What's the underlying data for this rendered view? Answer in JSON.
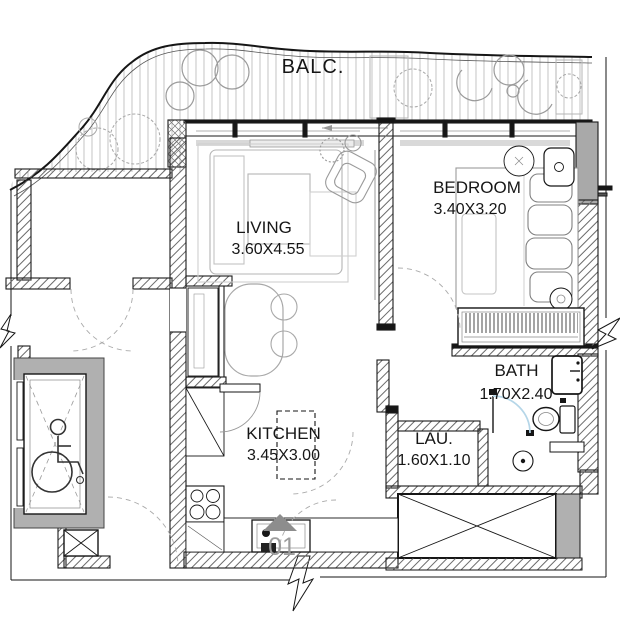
{
  "rooms": {
    "balcony": {
      "label": "BALC."
    },
    "living": {
      "label": "LIVING",
      "dimensions": "3.60X4.55"
    },
    "bedroom": {
      "label": "BEDROOM",
      "dimensions": "3.40X3.20"
    },
    "kitchen": {
      "label": "KITCHEN",
      "dimensions": "3.45X3.00"
    },
    "bath": {
      "label": "BATH",
      "dimensions": "1.70X2.40"
    },
    "laundry": {
      "label": "LAU.",
      "dimensions": "1.60X1.10"
    }
  },
  "unit": {
    "number": "01"
  },
  "icons": {
    "wheelchair": "accessible-elevator-icon",
    "entry_marker": "entry-triangle-icon",
    "break_marks": "break-arrow-icon",
    "drain": "floor-drain-icon"
  },
  "colors": {
    "wall_line": "#1a1a1a",
    "gray_fill": "#b0b0b0",
    "furniture_gray": "#b5b5b5",
    "door_arc_blue": "#b5d6e8",
    "unit_number_gray": "#9c9c9c",
    "entry_triangle_gray": "#8d8d8d"
  }
}
